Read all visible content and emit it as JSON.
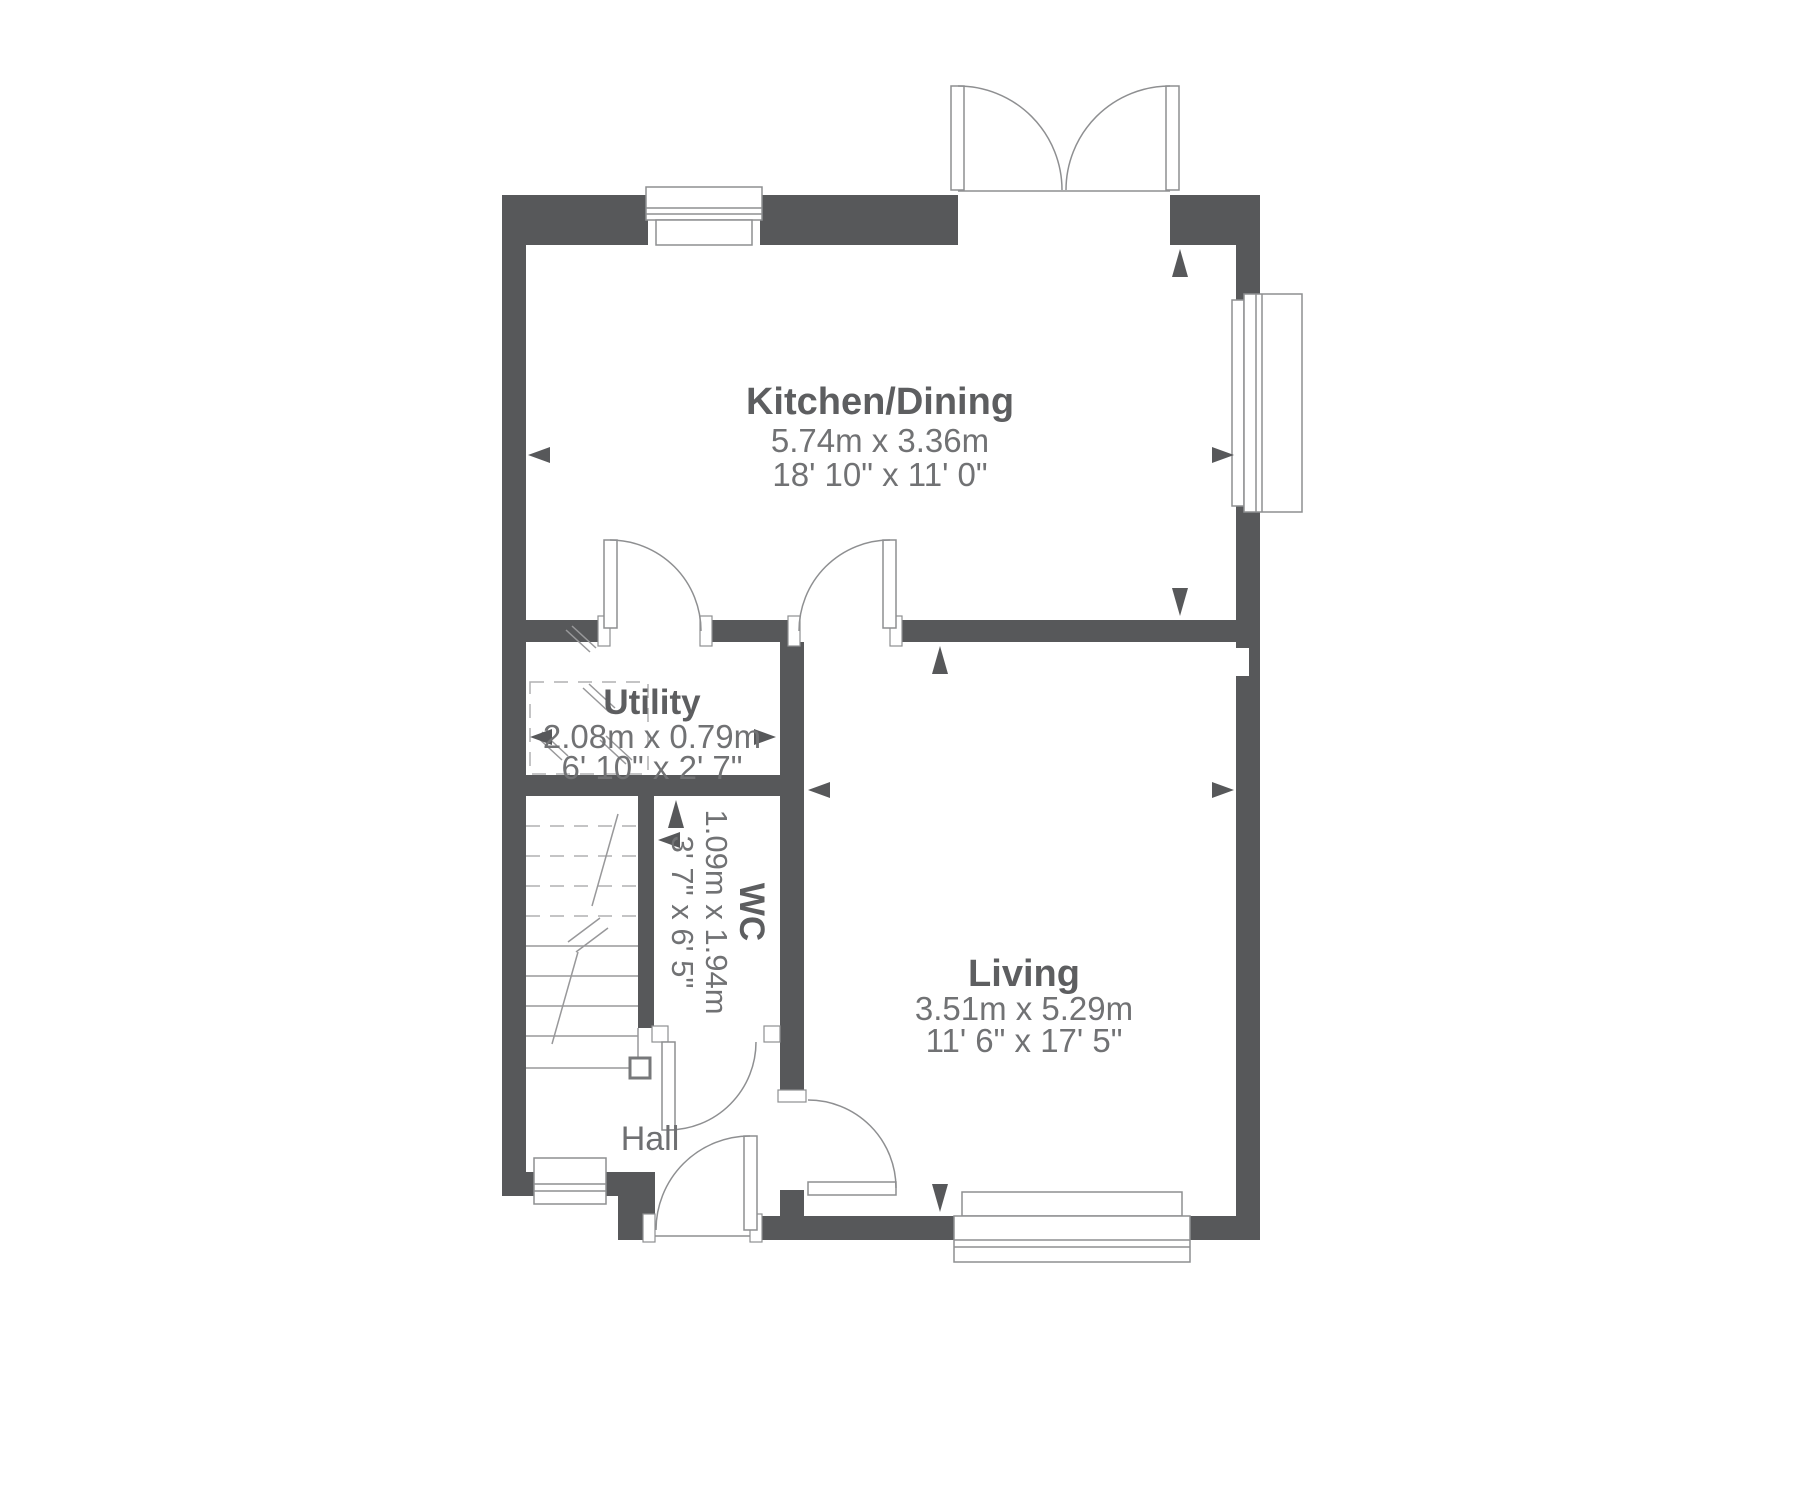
{
  "plan": {
    "type": "floorplan",
    "colors": {
      "wall": "#57585a",
      "room_title": "#5d5e60",
      "dimension_text": "#717274",
      "line": "#8e8f91",
      "background": "#ffffff"
    },
    "rooms": {
      "kitchen_dining": {
        "name": "Kitchen/Dining",
        "metric": "5.74m x 3.36m",
        "imperial": "18' 10\" x 11' 0\""
      },
      "utility": {
        "name": "Utility",
        "metric": "2.08m x 0.79m",
        "imperial": "6' 10\" x 2' 7\""
      },
      "wc": {
        "name": "WC",
        "metric": "1.09m x 1.94m",
        "imperial": "3' 7\" x 6' 5\"",
        "orientation": "rotated-90"
      },
      "living": {
        "name": "Living",
        "metric": "3.51m x 5.29m",
        "imperial": "11' 6\" x 17' 5\""
      },
      "hall": {
        "name": "Hall"
      }
    }
  }
}
